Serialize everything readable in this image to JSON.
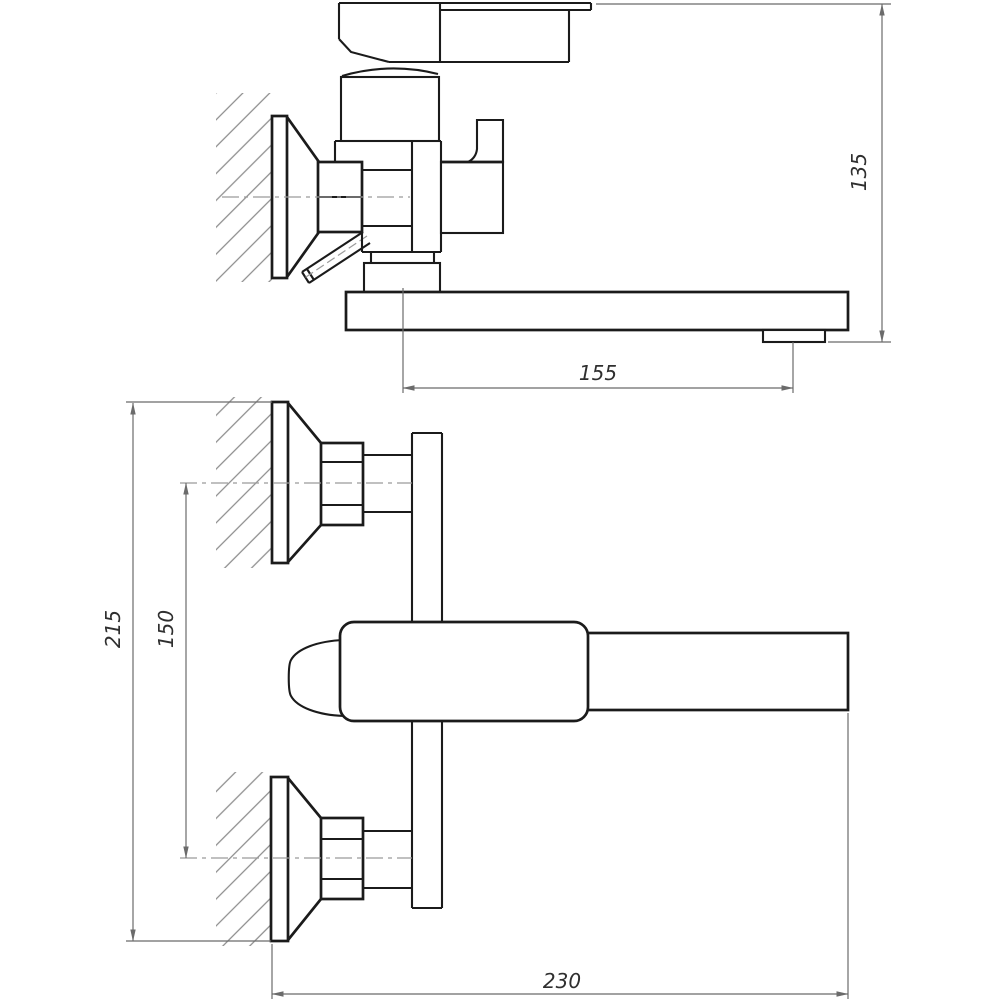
{
  "drawing": {
    "kind": "faucet installation technical drawing",
    "views": {
      "side_view": "upper view (side projection with wall section)",
      "front_view": "lower view (front projection with wall sections)"
    }
  },
  "dimensions": {
    "overall_height": "135",
    "spout_horizontal_offset": "155",
    "overall_vertical_span": "215",
    "inlet_centers_to_spout_axis": "150",
    "spout_reach_from_wall": "230"
  },
  "colors": {
    "outline": "#1b1b1b",
    "dimension": "#6b6b6b",
    "centerline": "#9b9b9b",
    "hatch": "#8c8c8c",
    "label": "#2f2f2f",
    "background": "#ffffff"
  }
}
